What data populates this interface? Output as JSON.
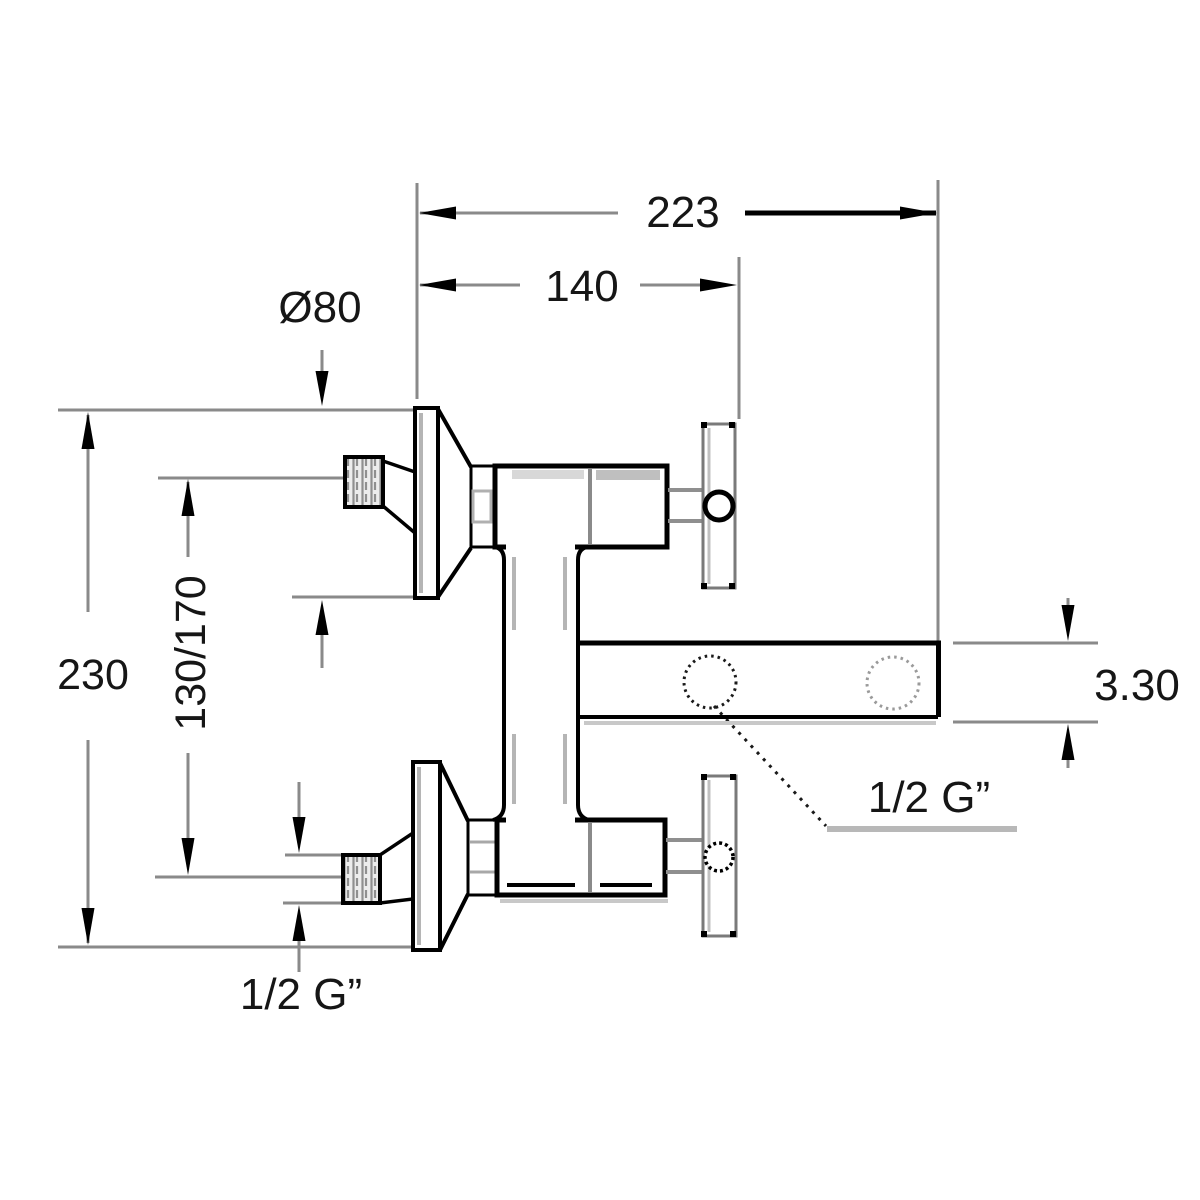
{
  "page": {
    "background": "#ffffff"
  },
  "drawing": {
    "subject": "wall-mounted two-handle bath mixer tap, dimensioned side elevation",
    "line_color": "#000000",
    "dimension_line_color": "#8a8a8a",
    "shading_color": "#c8c8c8",
    "dims": {
      "total_width": "223",
      "wall_to_handle": "140",
      "flange_diameter": "Ø80",
      "total_height": "230",
      "inlet_spacing": "130/170",
      "spout_section": "3.30",
      "spout_thread": "1/2 G”",
      "inlet_thread": "1/2 G”"
    }
  }
}
